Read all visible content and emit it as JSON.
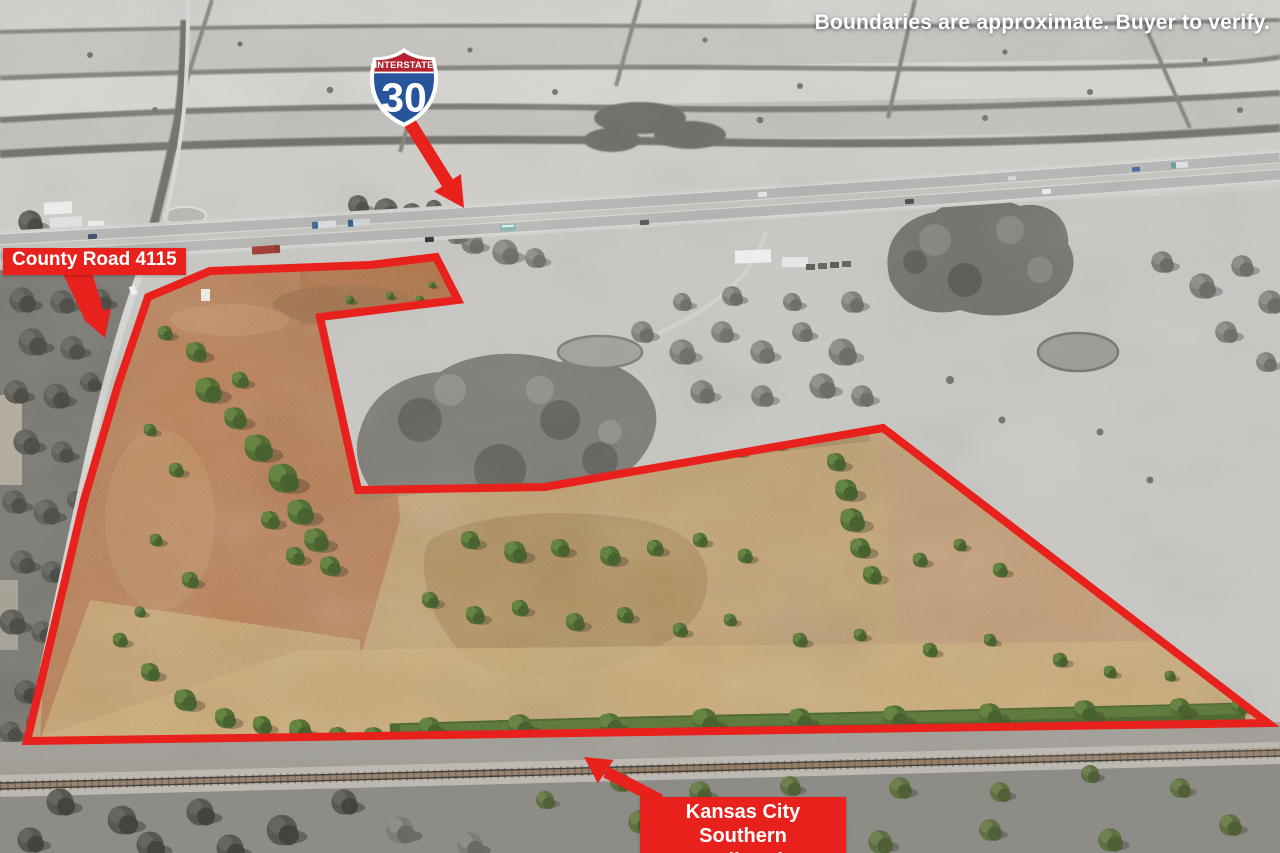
{
  "disclaimer": "Boundaries are approximate. Buyer to verify.",
  "shield": {
    "top_label": "INTERSTATE",
    "route_number": "30"
  },
  "callouts": {
    "road": "County Road 4115",
    "railroad_line1": "Kansas City Southern",
    "railroad_line2": "Railroad"
  },
  "colors": {
    "annotation_red": "#e8211c",
    "shield_red": "#b5232f",
    "shield_blue": "#27549b",
    "property_field_tan": "#c3a06e",
    "property_field_orange": "#b97c50",
    "tree_green": "#4c682c"
  },
  "boundary": {
    "stroke_width": 8,
    "points": [
      [
        148,
        297
      ],
      [
        210,
        271
      ],
      [
        370,
        265
      ],
      [
        436,
        257
      ],
      [
        458,
        300
      ],
      [
        320,
        317
      ],
      [
        358,
        490
      ],
      [
        545,
        487
      ],
      [
        883,
        428
      ],
      [
        1268,
        723
      ],
      [
        27,
        741
      ],
      [
        84,
        500
      ],
      [
        118,
        385
      ]
    ]
  }
}
